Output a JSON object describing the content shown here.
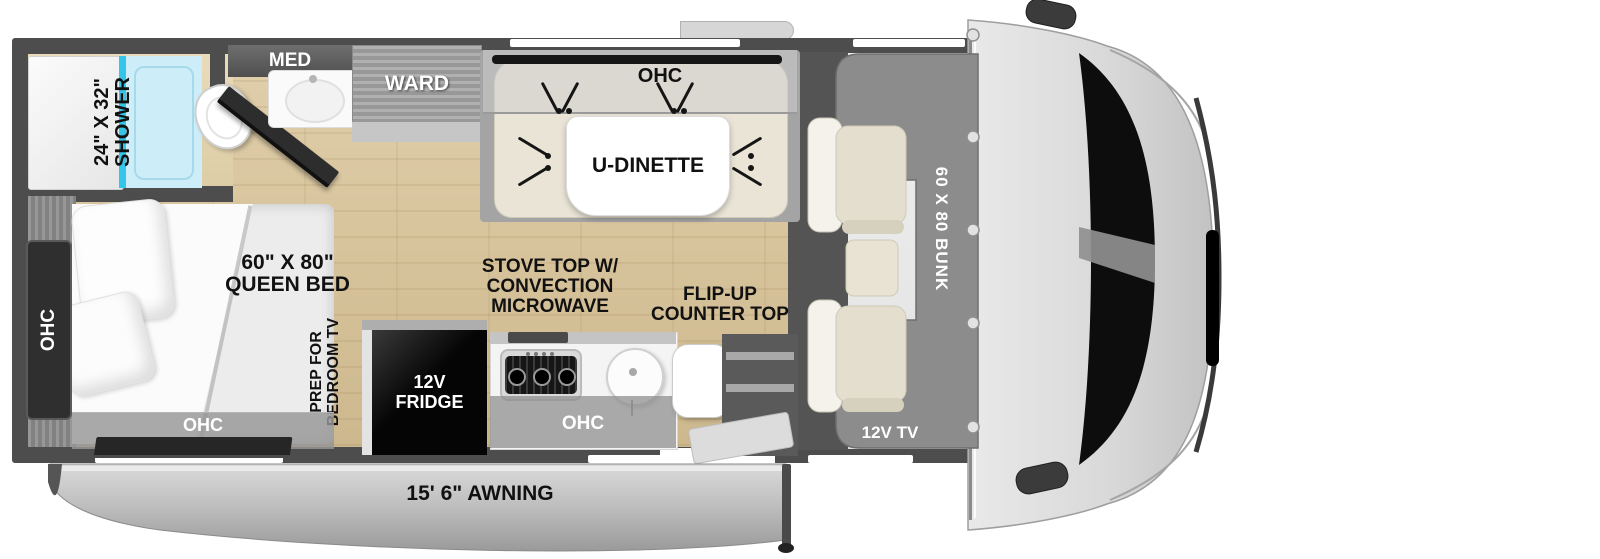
{
  "title": "Class C motorhome floor plan",
  "colors": {
    "wall": "#4d4d4d",
    "floor_wood": "#d8c5a0",
    "shower_glass": "#33c6e8",
    "shower_floor": "#cdeef9",
    "dinette_bench": "#e9e4d6",
    "bunk_gray": "#8c8c8c",
    "awning_gray": "#bdbdbd",
    "fridge_black": "#0a0a0a",
    "label_black": "#111111",
    "label_white": "#ffffff"
  },
  "labels": {
    "shower_size": "24\" X 32\"",
    "shower": "SHOWER",
    "med": "MED",
    "ward": "WARD",
    "dinette_ohc": "OHC",
    "dinette": "U-DINETTE",
    "stove1": "STOVE TOP W/",
    "stove2": "CONVECTION",
    "stove3": "MICROWAVE",
    "flip1": "FLIP-UP",
    "flip2": "COUNTER TOP",
    "bed_size": "60\" X 80\"",
    "bed": "QUEEN BED",
    "bedroom_ohc_side": "OHC",
    "bedroom_ohc_bottom": "OHC",
    "prep1": "PREP FOR",
    "prep2": "BEDROOM TV",
    "fridge1": "12V",
    "fridge2": "FRIDGE",
    "kitchen_ohc": "OHC",
    "bunk": "60 X 80 BUNK",
    "cab_tv": "12V TV",
    "awning": "15' 6\" AWNING"
  }
}
